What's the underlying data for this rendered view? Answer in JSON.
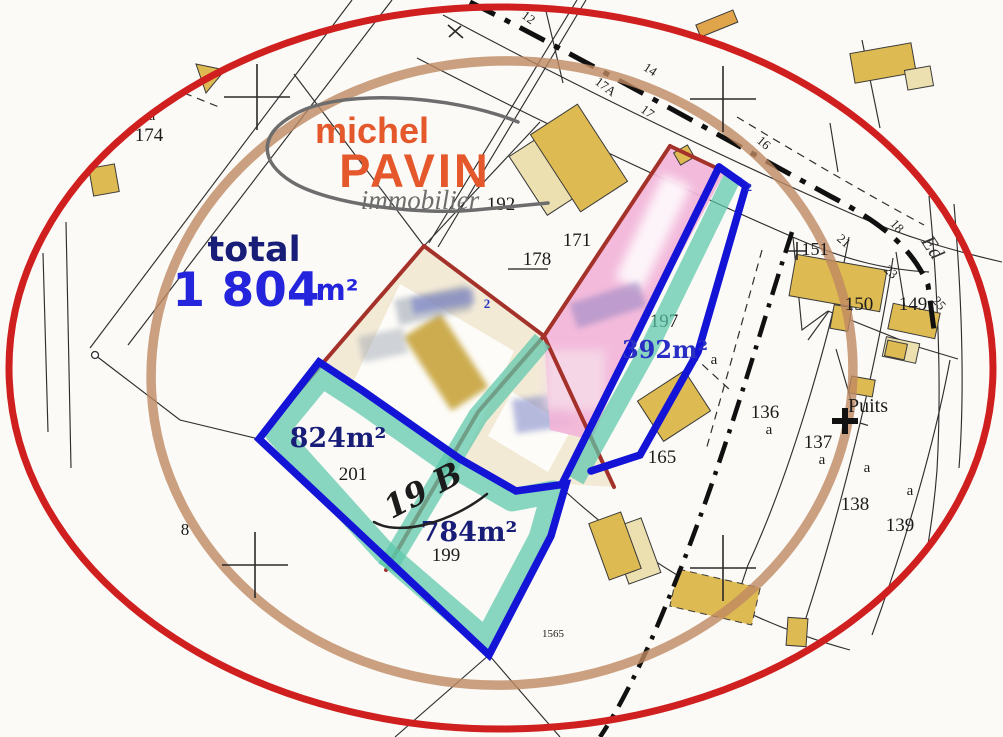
{
  "logo": {
    "name_first": "michel",
    "name_last": "PAVIN",
    "tagline": "immobilier"
  },
  "total": {
    "label": "total",
    "value": "1 804",
    "unit": "m²"
  },
  "lots": {
    "a824": "824m²",
    "a784": "784m²",
    "a392": "392m²",
    "handwritten_lot": "19 B"
  },
  "parcels": {
    "p8": "8",
    "p136": "136",
    "p137": "137",
    "p138": "138",
    "p139": "139",
    "p149": "149",
    "p150": "150",
    "p151": "151",
    "p165": "165",
    "p171": "171",
    "p174": "174",
    "p178": "178",
    "p192": "192",
    "p197": "197",
    "p199": "199",
    "p201": "201",
    "p1565": "1565"
  },
  "sub_letter": "a",
  "road": {
    "n12": "12",
    "n14": "14",
    "n17a": "17A",
    "n17": "17",
    "n16": "16",
    "n18": "18",
    "n21": "21",
    "n23": "23",
    "n25": "25",
    "street": "Ed"
  },
  "landmarks": {
    "well": "Puits"
  },
  "markers": {
    "point2": "2"
  },
  "colors": {
    "ellipse_red": "#cf1f1f",
    "circle_brown": "#bf8a63",
    "outline_blue": "#1414d6",
    "band_teal": "#5cc7ab",
    "parcel_red": "#a4322a",
    "fill_pink": "#f2b4d8",
    "fill_beige": "#f3ead6",
    "building_yellow": "#deba52",
    "building_pale": "#ece0b0",
    "navy_text": "#181d78",
    "blue_text": "#2424dd",
    "accent_blue_text": "#2a2fc4",
    "marker_blue": "#2a35c9",
    "logo_orange": "#e4582c",
    "logo_gray": "#6d6d6d"
  }
}
